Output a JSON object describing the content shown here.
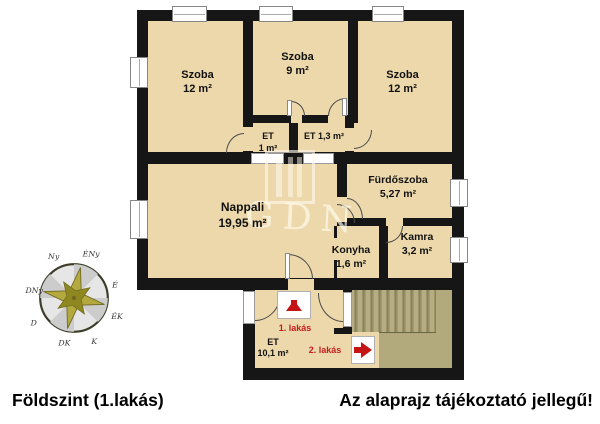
{
  "captions": {
    "floor": "Földszint (1.lakás)",
    "disclaimer": "Az alaprajz tájékoztató jellegű!"
  },
  "rooms": {
    "szoba_left": {
      "name": "Szoba",
      "area": "12 m²"
    },
    "szoba_middle": {
      "name": "Szoba",
      "area": "9 m²"
    },
    "szoba_right": {
      "name": "Szoba",
      "area": "12 m²"
    },
    "et_small": {
      "name": "ET",
      "area": "1 m²"
    },
    "et_13": {
      "label": "ET 1,3 m²"
    },
    "nappali": {
      "name": "Nappali",
      "area": "19,95 m²"
    },
    "furdoszoba": {
      "name": "Fürdőszoba",
      "area": "5,27 m²"
    },
    "konyha": {
      "name": "Konyha",
      "area": "1,6 m²"
    },
    "kamra": {
      "name": "Kamra",
      "area": "3,2 m²"
    },
    "eloter": {
      "name": "ET",
      "area": "10,1 m²"
    }
  },
  "annotations": {
    "apartment1": "1. lakás",
    "apartment2": "2. lakás"
  },
  "compass": {
    "e": "É",
    "ek": "ÉK",
    "k": "K",
    "dk": "DK",
    "d": "D",
    "dny": "DNy",
    "ny": "Ny",
    "eny": "ÉNy"
  },
  "watermark": {
    "text": "GDN"
  },
  "colors": {
    "wall": "#161616",
    "room_fill": "#ecd8ab",
    "stairs_fill": "#b2a97d",
    "accent_red": "#c41414",
    "background": "#ffffff"
  }
}
